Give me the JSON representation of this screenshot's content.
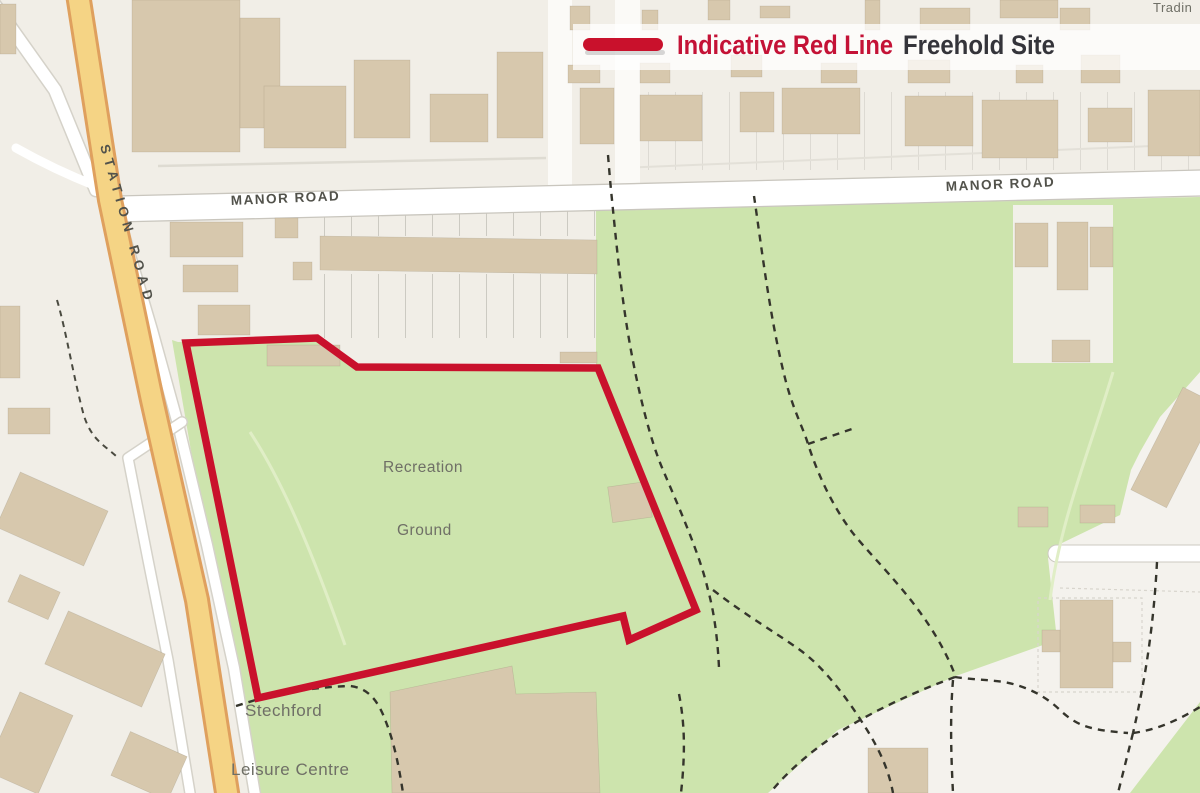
{
  "legend": {
    "line_label": "Indicative Red Line",
    "site_label": "Freehold Site"
  },
  "labels": {
    "station_road": "STATION ROAD",
    "manor_road_west": "MANOR ROAD",
    "manor_road_east": "MANOR ROAD",
    "recreation": "Recreation",
    "ground": "Ground",
    "stechford": "Stechford",
    "leisure_centre": "Leisure Centre",
    "trading_partial": "Tradin"
  },
  "colors": {
    "red_line": "#c9112c",
    "legend_red_text": "#c41236",
    "legend_dark_text": "#34343a",
    "park_green": "#cde4ad",
    "building_tan": "#d7c8ad",
    "road_yellow": "#f5d485",
    "road_yellow_casing": "#dfa05e",
    "background": "#f1eee7"
  }
}
